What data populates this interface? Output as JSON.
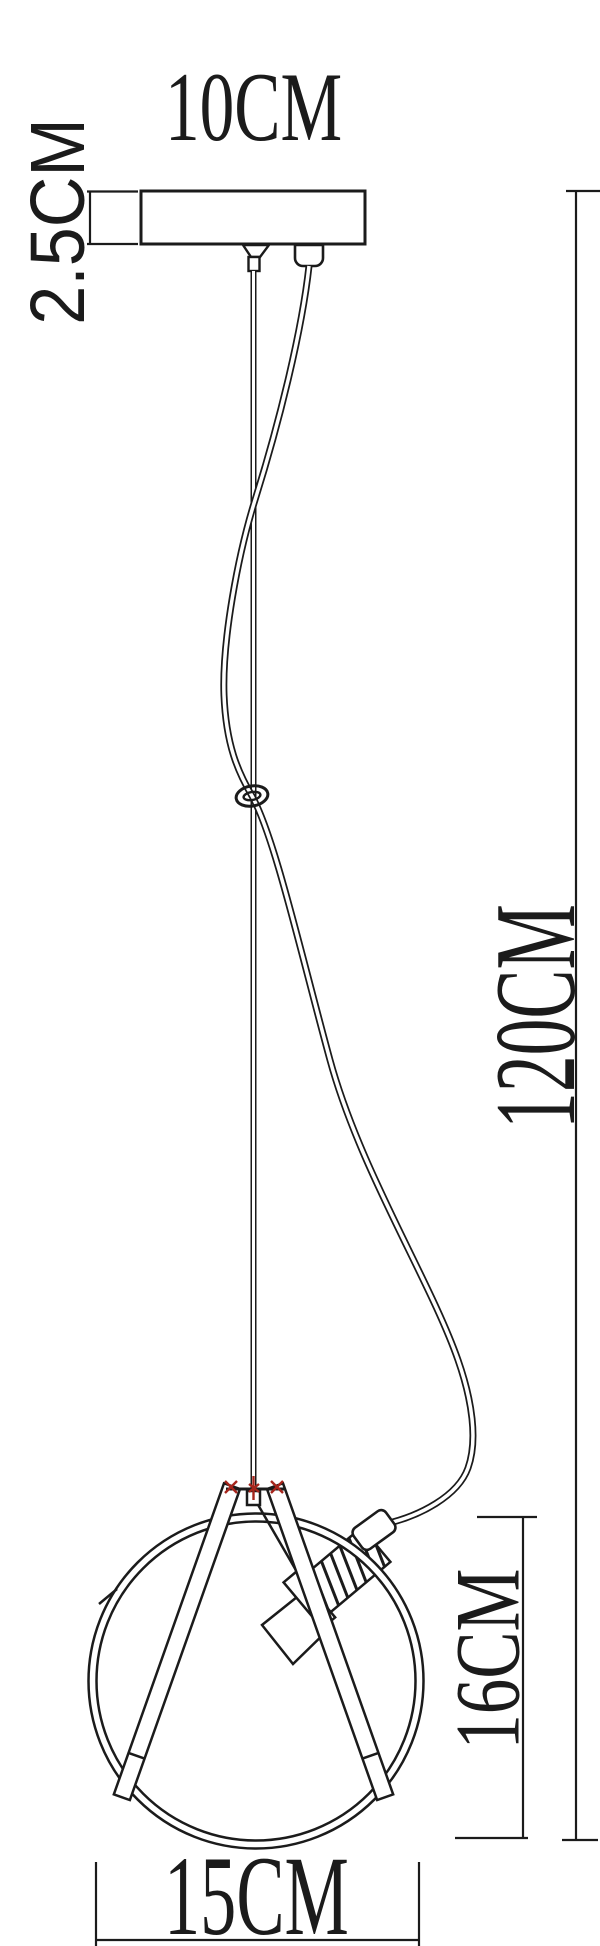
{
  "meta": {
    "description": "Pendant spotlight lamp dimension line drawing",
    "background": "#ffffff",
    "line_color": "#1b1b1b",
    "accent_red": "#a6251c"
  },
  "dimensions": {
    "canopy_width": "10CM",
    "canopy_height": "2.5CM",
    "suspension_length": "120CM",
    "lamp_height": "16CM",
    "lamp_diameter": "15CM"
  },
  "parts": {
    "canopy": "ceiling-canopy",
    "cone": "strain-relief-cone",
    "wire": "suspension-wire",
    "cord": "power-cord",
    "gland": "cord-gland",
    "loop": "cord-loop",
    "ring": "lamp-frame-ring",
    "arms": "support-arms",
    "spotlight": "spotlight-head",
    "reflector": "square-reflector"
  }
}
